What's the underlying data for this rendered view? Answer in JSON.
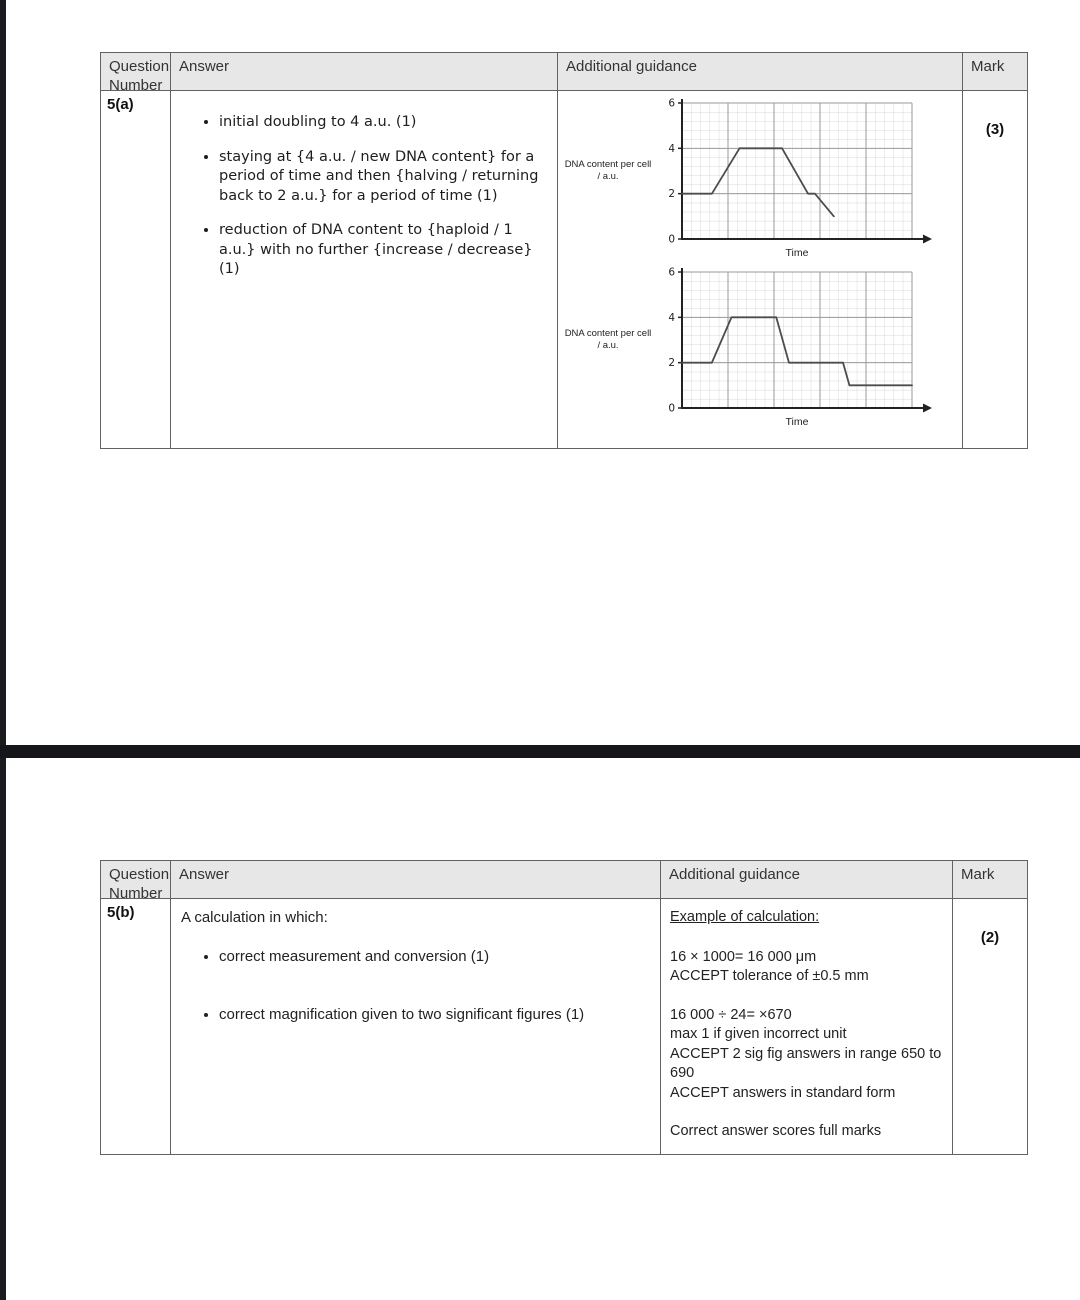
{
  "table_a": {
    "header": {
      "question": "Question Number",
      "answer": "Answer",
      "guidance": "Additional guidance",
      "mark": "Mark"
    },
    "question_number": "5(a)",
    "mark": "(3)",
    "bullets": [
      "initial doubling to 4 a.u. (1)",
      "staying at {4 a.u. / new DNA content} for a period of time and then {halving / returning back to 2 a.u.} for a period of time (1)",
      "reduction of DNA content to {haploid / 1 a.u.} with no further {increase / decrease} (1)"
    ]
  },
  "table_b": {
    "header": {
      "question": "Question Number",
      "answer": "Answer",
      "guidance": "Additional guidance",
      "mark": "Mark"
    },
    "question_number": "5(b)",
    "mark": "(2)",
    "answer_intro": "A calculation in which:",
    "bullets": [
      "correct measurement and conversion (1)",
      "correct magnification given to two significant figures (1)"
    ],
    "guidance": {
      "title": "Example of calculation:",
      "groups": [
        [
          "16 × 1000= 16 000 μm",
          "ACCEPT tolerance of ±0.5 mm"
        ],
        [
          "16 000 ÷ 24= ×670",
          "max 1 if given incorrect unit",
          "ACCEPT 2 sig fig answers in range 650 to 690",
          "ACCEPT answers in standard form"
        ],
        [
          "Correct answer scores full marks"
        ]
      ]
    }
  },
  "chart_data": [
    {
      "type": "line",
      "ylabel_lines": [
        "DNA content per cell",
        "/ a.u."
      ],
      "xlabel": "Time",
      "ylabel": "DNA content per cell / a.u.",
      "yticks": [
        0,
        2,
        4,
        6
      ],
      "ylim": [
        0,
        6
      ],
      "grid": "fine graph paper, major line every 5 small squares",
      "x_fraction_points": [
        [
          0,
          2
        ],
        [
          0.13,
          2
        ],
        [
          0.25,
          4
        ],
        [
          0.435,
          4
        ],
        [
          0.548,
          2
        ],
        [
          0.578,
          2
        ],
        [
          0.66,
          1
        ]
      ]
    },
    {
      "type": "line",
      "ylabel_lines": [
        "DNA content per cell",
        "/ a.u."
      ],
      "xlabel": "Time",
      "ylabel": "DNA content per cell / a.u.",
      "yticks": [
        0,
        2,
        4,
        6
      ],
      "ylim": [
        0,
        6
      ],
      "grid": "fine graph paper, major line every 5 small squares",
      "x_fraction_points": [
        [
          0,
          2
        ],
        [
          0.13,
          2
        ],
        [
          0.215,
          4
        ],
        [
          0.41,
          4
        ],
        [
          0.465,
          2
        ],
        [
          0.7,
          2
        ],
        [
          0.728,
          1
        ],
        [
          1,
          1
        ]
      ]
    }
  ]
}
